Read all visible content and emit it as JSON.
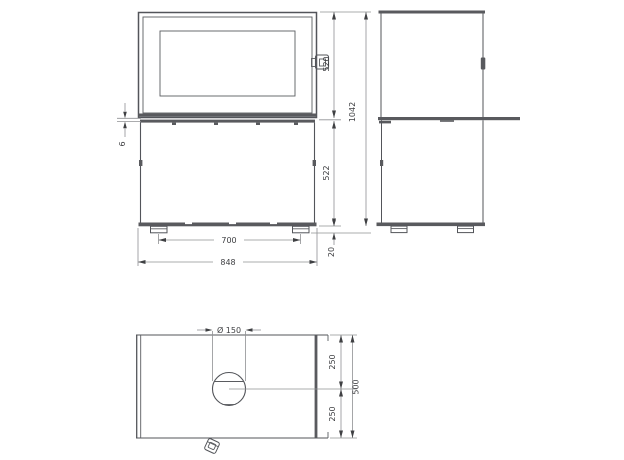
{
  "drawing_title": "stove-three-view-dimension-drawing",
  "views": {
    "front": "front-view",
    "side": "side-view",
    "top": "top-view"
  },
  "dimensions": {
    "front": {
      "door_height": "520",
      "gap": "6",
      "body_height": "522",
      "foot_height": "20",
      "feet_spacing": "700",
      "width": "848"
    },
    "side": {
      "total_height": "1042"
    },
    "top": {
      "flue_diameter": "Ø 150",
      "front_to_flue_center": "250",
      "flue_center_to_back": "250",
      "depth": "500"
    }
  },
  "colors": {
    "object_line": "#53555a",
    "dimension_line": "#8f9093",
    "text": "#3e3f42",
    "background": "#ffffff"
  }
}
